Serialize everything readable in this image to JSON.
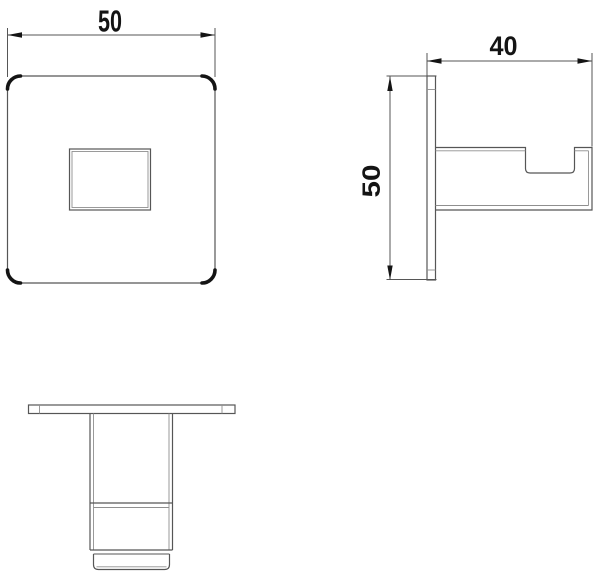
{
  "drawing": {
    "kind": "technical-drawing-3-views-wall-hook",
    "background": "#ffffff",
    "line_color": "#565656",
    "edge_line_color": "#8f8f8f",
    "accent_color": "#141414",
    "dims": {
      "front_width": "50",
      "side_depth": "40",
      "side_height": "50"
    }
  }
}
